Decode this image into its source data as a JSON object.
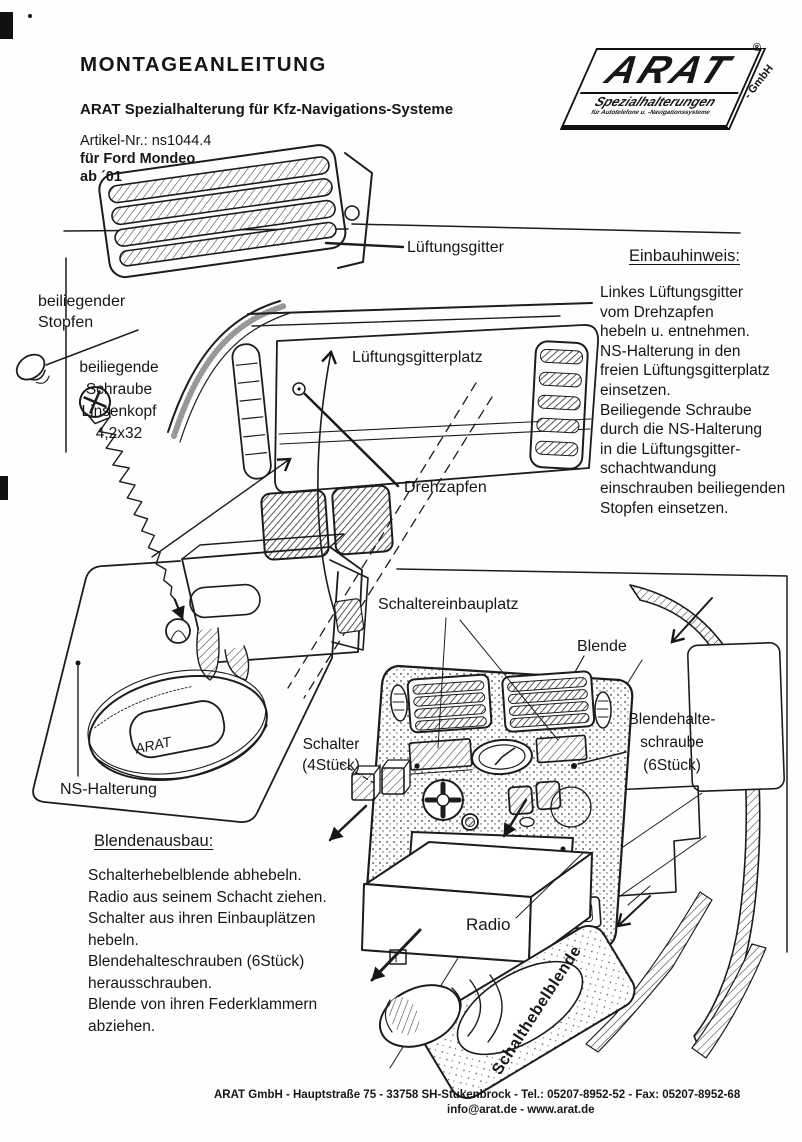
{
  "header": {
    "title": "MONTAGEANLEITUNG",
    "subtitle": "ARAT Spezialhalterung für Kfz-Navigations-Systeme",
    "article_no": "Artikel-Nr.: ns1044.4",
    "article_model": "für Ford Mondeo",
    "article_year": "ab ´01"
  },
  "logo": {
    "brand": "ARAT",
    "registered": "®",
    "suffix": "- GmbH",
    "tagline": "Spezialhalterungen",
    "subtagline": "für Autotelefone u. -Navigationssysteme"
  },
  "labels": {
    "lueftungsgitter": "Lüftungsgitter",
    "stopfen": "beiliegender\nStopfen",
    "schraube": "beiliegende\nSchraube\nLinsenkopf\n4,2x32",
    "lueftungsgitterplatz": "Lüftungsgitterplatz",
    "drehzapfen": "Drehzapfen",
    "ns_halterung": "NS-Halterung",
    "schaltereinbauplatz": "Schaltereinbauplatz",
    "blende": "Blende",
    "schalter": "Schalter\n(4Stück)",
    "blendehalteschraube": "Blendehalte-\nschraube\n(6Stück)",
    "radio": "Radio",
    "schalthebelblende": "Schalthebelblende",
    "ring_brand": "ARAT"
  },
  "einbauhinweis": {
    "heading": "Einbauhinweis:",
    "body": "Linkes Lüftungsgitter\nvom Drehzapfen\nhebeln u. entnehmen.\nNS-Halterung in den\nfreien Lüftungsgitterplatz\neinsetzen.\nBeiliegende Schraube\ndurch die NS-Halterung\nin die Lüftungsgitter-\nschachtwandung\neinschrauben beiliegenden\nStopfen einsetzen."
  },
  "blendenausbau": {
    "heading": "Blendenausbau:",
    "body": "Schalterhebelblende abhebeln.\nRadio aus seinem Schacht ziehen.\nSchalter aus ihren Einbauplätzen\nhebeln.\nBlendehalteschrauben (6Stück)\nherausschrauben.\nBlende von ihren Federklammern\nabziehen."
  },
  "footer": {
    "line1": "ARAT GmbH - Hauptstraße 75 - 33758 SH-Stukenbrock - Tel.: 05207-8952-52 - Fax: 05207-8952-68",
    "line2": "info@arat.de - www.arat.de"
  }
}
